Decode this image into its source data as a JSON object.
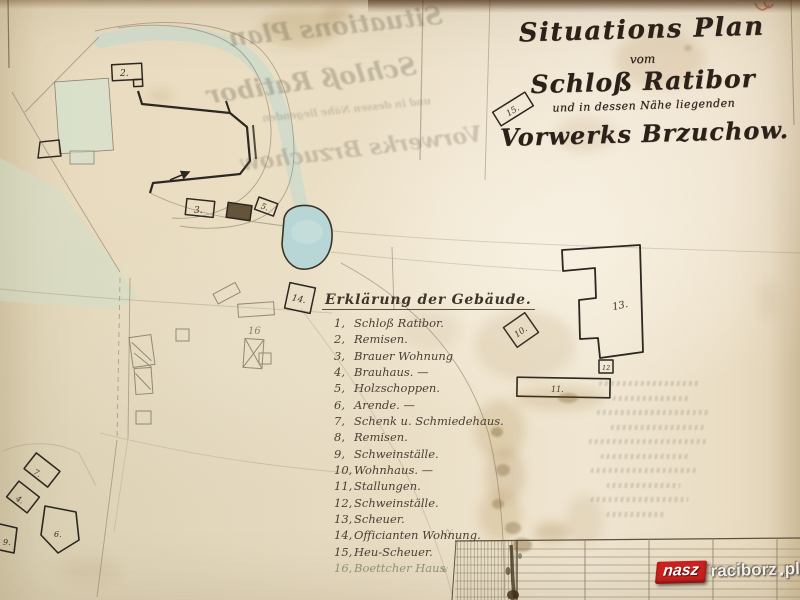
{
  "title_block": {
    "line1": "Situations Plan",
    "line2": "vom",
    "line3": "Schloß Ratibor",
    "line4": "und in dessen Nähe liegenden",
    "line5": "Vorwerks Brzuchow."
  },
  "legend": {
    "title": "Erklärung der Gebäude.",
    "items": [
      {
        "num": "1,",
        "label": "Schloß Ratibor."
      },
      {
        "num": "2,",
        "label": "Remisen."
      },
      {
        "num": "3,",
        "label": "Brauer Wohnung"
      },
      {
        "num": "4,",
        "label": "Brauhaus. —"
      },
      {
        "num": "5,",
        "label": "Holzschoppen."
      },
      {
        "num": "6,",
        "label": "Arende. —"
      },
      {
        "num": "7,",
        "label": "Schenk u. Schmiedehaus."
      },
      {
        "num": "8,",
        "label": "Remisen."
      },
      {
        "num": "9,",
        "label": "Schweinställe."
      },
      {
        "num": "10,",
        "label": "Wohnhaus. —"
      },
      {
        "num": "11,",
        "label": "Stallungen."
      },
      {
        "num": "12,",
        "label": "Schweinställe."
      },
      {
        "num": "13,",
        "label": "Scheuer."
      },
      {
        "num": "14,",
        "label": "Officianten Wohnung."
      },
      {
        "num": "15,",
        "label": "Heu-Scheuer."
      },
      {
        "num": "16,",
        "label": "Boettcher Haus"
      }
    ]
  },
  "map": {
    "labels": {
      "b1_arrow": "1",
      "b2": "2.",
      "b3": "3.",
      "b5": "5.",
      "b4": "4.",
      "b6": "6.",
      "b7": "7.",
      "b9": "9.",
      "b10": "10.",
      "b11": "11.",
      "b12": "12",
      "b13": "13.",
      "b14": "14.",
      "b15": "15.",
      "b16": "16"
    },
    "scale_marks": {
      "m1": "12.",
      "m2": "6."
    }
  },
  "bleed_through": {
    "ghost1": "Situations Plan",
    "ghost2": "Schloß Ratibor",
    "ghost3": "und in dessen Nähe liegenden",
    "ghost4": "Vorwerks Brzuchow"
  },
  "watermark": {
    "part1": "nasz",
    "part2": "raciborz",
    "part3": "pl",
    "red": "#c9211e"
  },
  "colors": {
    "paper": "#e9dcc0",
    "ink": "#2c2720",
    "legend_ink": "#4a4033",
    "pencil": "#7d7560",
    "teal_wash": "#bfd9d1",
    "pond": "#b8d6d5",
    "green_wash": "#cfdec9",
    "stain": "#9c7434",
    "watermark_red": "#c9211e"
  }
}
